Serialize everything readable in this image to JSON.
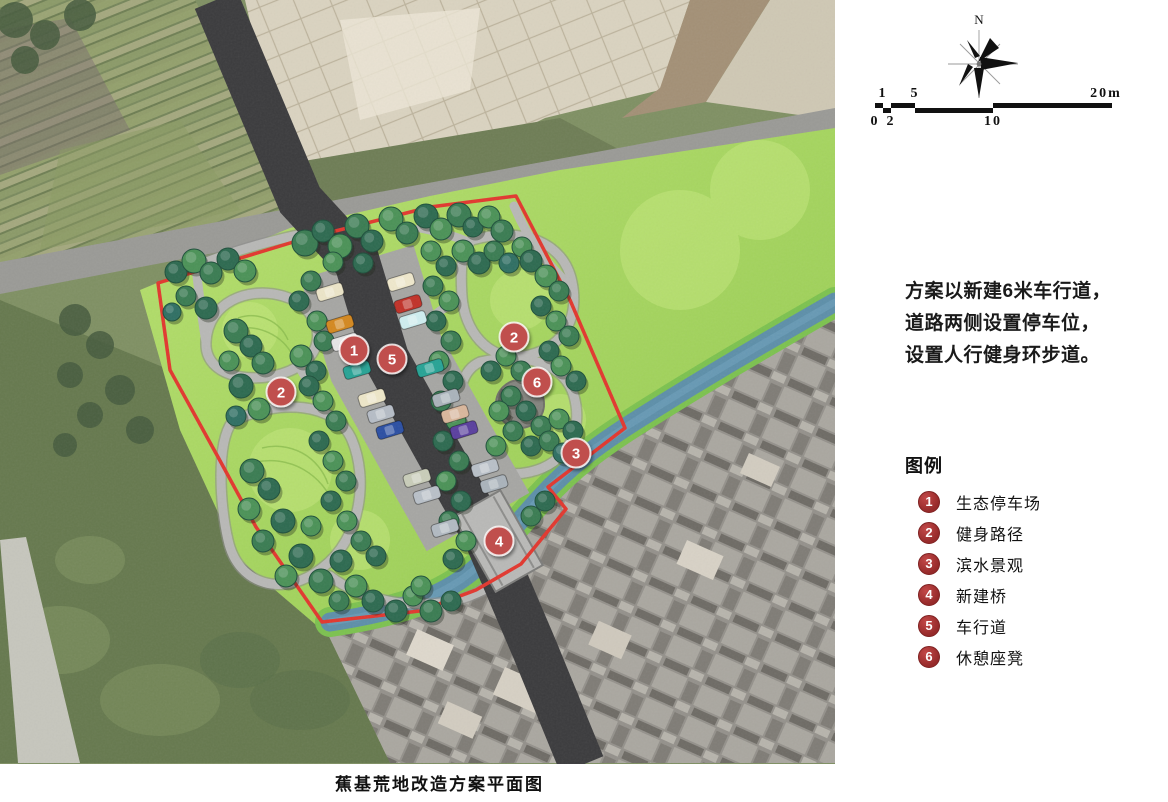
{
  "caption": "蕉基荒地改造方案平面图",
  "compass": {
    "label": "N"
  },
  "scale_bar": {
    "segments": [
      {
        "x0": 875,
        "x1": 883,
        "row": "top"
      },
      {
        "x0": 883,
        "x1": 891,
        "row": "bot"
      },
      {
        "x0": 891,
        "x1": 915,
        "row": "top"
      },
      {
        "x0": 915,
        "x1": 993,
        "row": "bot"
      },
      {
        "x0": 993,
        "x1": 1112,
        "row": "top"
      }
    ],
    "top_labels": [
      {
        "text": "1",
        "x": 883
      },
      {
        "text": "5",
        "x": 915
      },
      {
        "text": "20m",
        "x": 1106
      }
    ],
    "bottom_labels": [
      {
        "text": "0",
        "x": 875
      },
      {
        "text": "2",
        "x": 891
      },
      {
        "text": "10",
        "x": 993
      }
    ]
  },
  "description": {
    "lines": [
      "方案以新建6米车行道，",
      "道路两侧设置停车位，",
      "设置人行健身环步道。"
    ]
  },
  "legend": {
    "title": "图例",
    "items": [
      {
        "num": "1",
        "label": "生态停车场"
      },
      {
        "num": "2",
        "label": "健身路径"
      },
      {
        "num": "3",
        "label": "滨水景观"
      },
      {
        "num": "4",
        "label": "新建桥"
      },
      {
        "num": "5",
        "label": "车行道"
      },
      {
        "num": "6",
        "label": "休憩座凳"
      }
    ]
  },
  "colors": {
    "boundary_red": "#e2372e",
    "marker_red": "#c0504d",
    "legend_badge_red": "#a83434",
    "road_dark": "#3b3b3d",
    "river_blue": "#5d8fa9",
    "river_bank_green": "#7cc24f",
    "lawn_wash_green": "#a6d65f",
    "tree_palette": [
      "#2d6a50",
      "#3a7c52",
      "#4b9257",
      "#5fa75c",
      "#79bd66",
      "#2f6f63"
    ],
    "tree_outline": "#1e4f3b"
  },
  "map": {
    "markers": [
      {
        "num": "1",
        "x": 354,
        "y": 350
      },
      {
        "num": "5",
        "x": 392,
        "y": 359
      },
      {
        "num": "2",
        "x": 514,
        "y": 337
      },
      {
        "num": "6",
        "x": 537,
        "y": 382
      },
      {
        "num": "2",
        "x": 281,
        "y": 392
      },
      {
        "num": "3",
        "x": 576,
        "y": 453
      },
      {
        "num": "4",
        "x": 499,
        "y": 541
      }
    ],
    "trees": [
      [
        305,
        243,
        13,
        1
      ],
      [
        323,
        231,
        11,
        0
      ],
      [
        340,
        246,
        12,
        2
      ],
      [
        357,
        226,
        12,
        1
      ],
      [
        372,
        241,
        11,
        0
      ],
      [
        391,
        219,
        12,
        2
      ],
      [
        407,
        233,
        11,
        1
      ],
      [
        426,
        216,
        12,
        0
      ],
      [
        441,
        229,
        11,
        2
      ],
      [
        459,
        215,
        12,
        1
      ],
      [
        473,
        227,
        10,
        0
      ],
      [
        489,
        217,
        11,
        2
      ],
      [
        502,
        231,
        11,
        1
      ],
      [
        333,
        262,
        10,
        2
      ],
      [
        363,
        263,
        10,
        0
      ],
      [
        463,
        251,
        11,
        2
      ],
      [
        479,
        263,
        11,
        0
      ],
      [
        494,
        251,
        10,
        1
      ],
      [
        509,
        263,
        10,
        5
      ],
      [
        522,
        247,
        10,
        2
      ],
      [
        176,
        272,
        11,
        0
      ],
      [
        194,
        261,
        12,
        2
      ],
      [
        211,
        273,
        11,
        1
      ],
      [
        228,
        259,
        11,
        0
      ],
      [
        245,
        271,
        11,
        2
      ],
      [
        186,
        296,
        10,
        1
      ],
      [
        206,
        308,
        11,
        0
      ],
      [
        172,
        312,
        9,
        5
      ],
      [
        236,
        331,
        12,
        1
      ],
      [
        251,
        346,
        11,
        0
      ],
      [
        229,
        361,
        10,
        2
      ],
      [
        263,
        363,
        11,
        1
      ],
      [
        241,
        386,
        12,
        0
      ],
      [
        259,
        409,
        11,
        2
      ],
      [
        236,
        416,
        10,
        5
      ],
      [
        301,
        356,
        11,
        2
      ],
      [
        316,
        371,
        10,
        0
      ],
      [
        252,
        471,
        12,
        1
      ],
      [
        269,
        489,
        11,
        0
      ],
      [
        249,
        509,
        11,
        2
      ],
      [
        283,
        521,
        12,
        0
      ],
      [
        263,
        541,
        11,
        1
      ],
      [
        301,
        556,
        12,
        0
      ],
      [
        286,
        576,
        11,
        2
      ],
      [
        321,
        581,
        12,
        1
      ],
      [
        341,
        561,
        11,
        0
      ],
      [
        356,
        586,
        11,
        2
      ],
      [
        373,
        601,
        11,
        0
      ],
      [
        339,
        601,
        10,
        1
      ],
      [
        311,
        526,
        10,
        2
      ],
      [
        396,
        611,
        11,
        0
      ],
      [
        413,
        596,
        10,
        2
      ],
      [
        431,
        611,
        11,
        1
      ],
      [
        451,
        601,
        10,
        0
      ],
      [
        421,
        586,
        10,
        2
      ],
      [
        311,
        281,
        10,
        1
      ],
      [
        299,
        301,
        10,
        0
      ],
      [
        317,
        321,
        10,
        2
      ],
      [
        324,
        341,
        10,
        1
      ],
      [
        309,
        386,
        10,
        0
      ],
      [
        323,
        401,
        10,
        2
      ],
      [
        336,
        421,
        10,
        1
      ],
      [
        319,
        441,
        10,
        0
      ],
      [
        333,
        461,
        10,
        2
      ],
      [
        346,
        481,
        10,
        1
      ],
      [
        331,
        501,
        10,
        0
      ],
      [
        347,
        521,
        10,
        2
      ],
      [
        361,
        541,
        10,
        1
      ],
      [
        376,
        556,
        10,
        0
      ],
      [
        431,
        251,
        10,
        2
      ],
      [
        446,
        266,
        10,
        0
      ],
      [
        433,
        286,
        10,
        1
      ],
      [
        449,
        301,
        10,
        2
      ],
      [
        436,
        321,
        10,
        0
      ],
      [
        451,
        341,
        10,
        1
      ],
      [
        439,
        361,
        10,
        2
      ],
      [
        453,
        381,
        10,
        0
      ],
      [
        441,
        401,
        10,
        1
      ],
      [
        456,
        421,
        10,
        2
      ],
      [
        443,
        441,
        10,
        0
      ],
      [
        459,
        461,
        10,
        1
      ],
      [
        446,
        481,
        10,
        2
      ],
      [
        461,
        501,
        10,
        0
      ],
      [
        449,
        521,
        10,
        1
      ],
      [
        466,
        541,
        10,
        2
      ],
      [
        453,
        559,
        10,
        0
      ],
      [
        531,
        261,
        11,
        0
      ],
      [
        546,
        276,
        11,
        2
      ],
      [
        559,
        291,
        10,
        1
      ],
      [
        541,
        306,
        10,
        0
      ],
      [
        556,
        321,
        10,
        2
      ],
      [
        569,
        336,
        10,
        1
      ],
      [
        549,
        351,
        10,
        0
      ],
      [
        506,
        356,
        10,
        2
      ],
      [
        491,
        371,
        10,
        0
      ],
      [
        521,
        371,
        10,
        1
      ],
      [
        561,
        366,
        10,
        2
      ],
      [
        576,
        381,
        10,
        0
      ],
      [
        511,
        396,
        10,
        1
      ],
      [
        499,
        411,
        10,
        2
      ],
      [
        526,
        411,
        10,
        0
      ],
      [
        541,
        426,
        10,
        1
      ],
      [
        559,
        419,
        10,
        2
      ],
      [
        573,
        431,
        10,
        0
      ],
      [
        513,
        431,
        10,
        1
      ],
      [
        496,
        446,
        10,
        2
      ],
      [
        531,
        446,
        10,
        0
      ],
      [
        549,
        441,
        10,
        1
      ],
      [
        563,
        453,
        10,
        5
      ],
      [
        545,
        501,
        10,
        0
      ],
      [
        531,
        516,
        10,
        1
      ]
    ],
    "cars": [
      [
        330,
        292,
        "#ece5c8"
      ],
      [
        340,
        324,
        "#d4881f"
      ],
      [
        345,
        342,
        "#e6e6e6"
      ],
      [
        357,
        370,
        "#27a395"
      ],
      [
        372,
        398,
        "#eee7c9"
      ],
      [
        381,
        414,
        "#b6bdc6"
      ],
      [
        390,
        430,
        "#2b4fa3"
      ],
      [
        417,
        478,
        "#c9cdb9"
      ],
      [
        427,
        495,
        "#b9c0c8"
      ],
      [
        445,
        528,
        "#b2bac2"
      ],
      [
        401,
        282,
        "#efe8cc"
      ],
      [
        408,
        304,
        "#c13128"
      ],
      [
        413,
        320,
        "#cfeef0"
      ],
      [
        430,
        368,
        "#27a395"
      ],
      [
        446,
        398,
        "#aab3bb"
      ],
      [
        455,
        414,
        "#d9b79c"
      ],
      [
        464,
        430,
        "#5a3f9e"
      ],
      [
        485,
        468,
        "#b9c0c8"
      ],
      [
        494,
        484,
        "#aab3bb"
      ]
    ]
  }
}
